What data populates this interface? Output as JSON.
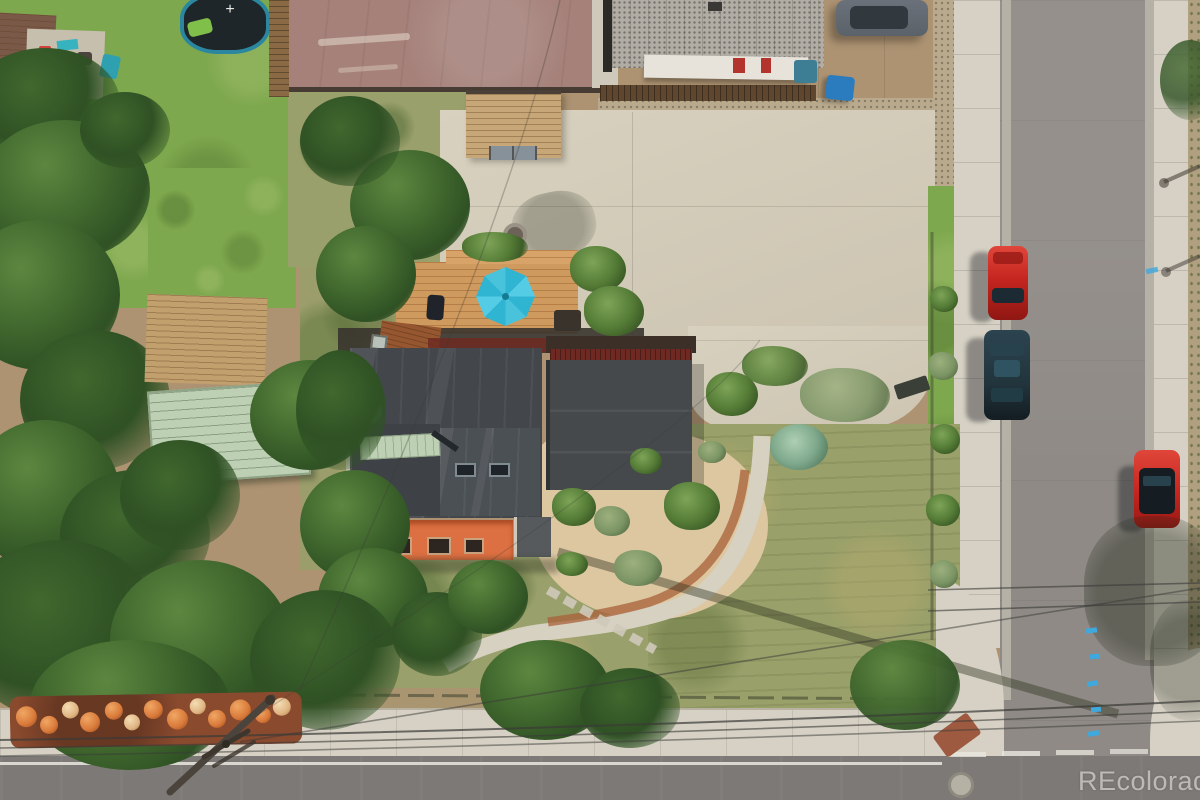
{
  "meta": {
    "kind": "aerial-drone-photograph",
    "subject": "top-down view of a corner-lot property with dark flat-roof house, wood deck with teal patio umbrella, large concrete driveway, xeriscape yard, tree-filled neighboring yards, and an intersection of two streets with parked cars"
  },
  "watermark": {
    "text": "REcolorado"
  },
  "palette": {
    "lawn": "#7ea84e",
    "lawnDark": "#5f8a3c",
    "treeDark": "#2f5124",
    "treeMid": "#41682e",
    "treeLight": "#5d8740",
    "field": "#99a069",
    "sand": "#dcc7a1",
    "dirt": "#ad9372",
    "gravel": "#b9a98d",
    "concrete": "#d3ccba",
    "sidewalk": "#d6d1c4",
    "asphalt": "#8f8a85",
    "roadDark": "#7d7976",
    "mauve": "#a5817a",
    "roofCharcoal": "#43474b",
    "roofRed": "#6e2a22",
    "rust": "#96562f",
    "awning": "#dd7042",
    "deck": "#cf9a5e",
    "umbrella": "#2fb4d2",
    "mint": "#bed0b4",
    "tanRoof": "#c2a06e",
    "brownRoof": "#7b5948",
    "redCar": "#c5251f",
    "darkCar": "#22343c",
    "grayCar": "#5b6269",
    "blueBin": "#2b7cbe",
    "barrel": "#d97a3a",
    "barrelBed": "#8a4a2e",
    "wire": "#3a3a38",
    "roadLine": "#e9e7df",
    "bluePaint": "#3fa8dd",
    "watermark": "rgba(244,244,239,0.58)"
  },
  "scene": {
    "objects": [
      "house-roof",
      "garage-roof",
      "orange-awning",
      "skylight",
      "wood-deck",
      "patio-umbrella",
      "bbq-grill",
      "concrete-driveway",
      "storage-shed",
      "fire-pit",
      "trampoline",
      "neighbor-roof",
      "mint-metal-roof",
      "xeriscape-path",
      "red-gravel-path",
      "weedy-field",
      "vertical-street",
      "bottom-street",
      "intersection-corner",
      "red-car-north",
      "dark-suv",
      "red-car-east",
      "gray-car-top",
      "blue-trash-bin",
      "rv-trailer",
      "speckled-roof-building",
      "orange-barrel-pile",
      "utility-pole",
      "power-lines",
      "streetlight-shadow",
      "manhole-cover",
      "curb-ramp-mat",
      "blue-utility-markings",
      "crosswalk-dashes",
      "trees",
      "bushes",
      "watermark"
    ]
  }
}
